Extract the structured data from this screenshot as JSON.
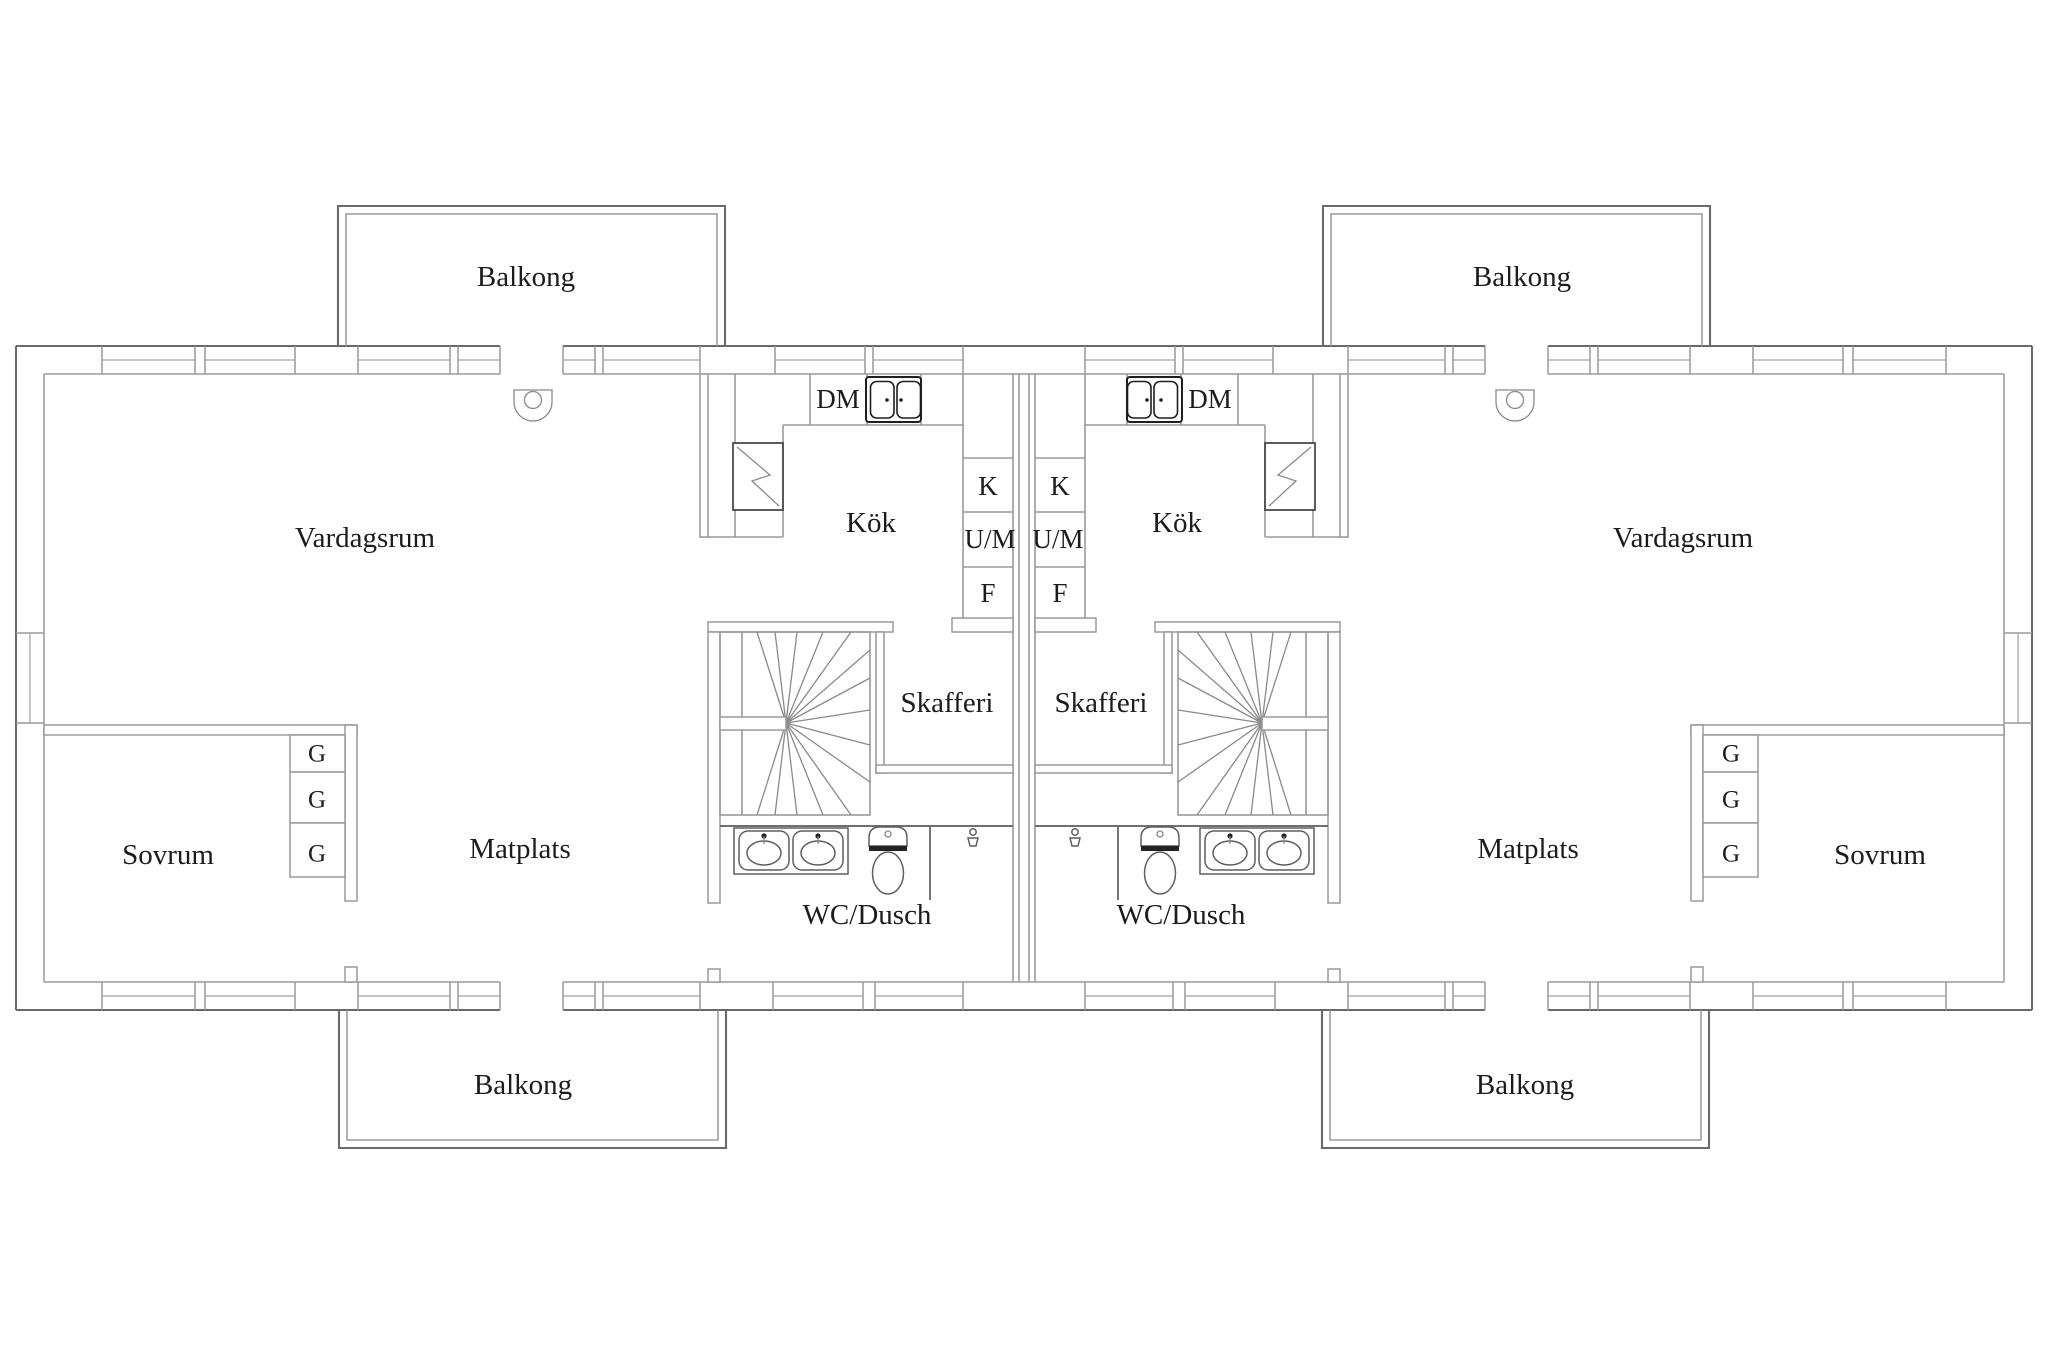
{
  "labels": {
    "balkong": "Balkong",
    "vardagsrum": "Vardagsrum",
    "kok": "Kök",
    "dm": "DM",
    "k": "K",
    "um": "U/M",
    "f": "F",
    "skafferi": "Skafferi",
    "sovrum": "Sovrum",
    "matplats": "Matplats",
    "wc_dusch": "WC/Dusch",
    "g": "G"
  },
  "colors": {
    "background": "#ffffff",
    "wall_line": "#9a9a9a",
    "outer_wall_line": "#6a6a6a",
    "text": "#1c1c1c",
    "fixture_dark": "#1f1f1f"
  },
  "icons": {
    "kitchen_sink": "double-bowl-sink-icon",
    "duct": "zigzag-duct-icon",
    "ceiling_lamp": "ceiling-lamp-icon",
    "stairs": "winder-staircase-icon",
    "washbasin": "washbasin-icon",
    "toilet": "toilet-icon",
    "shower": "shower-head-icon",
    "wardrobe": "wardrobe-cabinet-icon"
  }
}
